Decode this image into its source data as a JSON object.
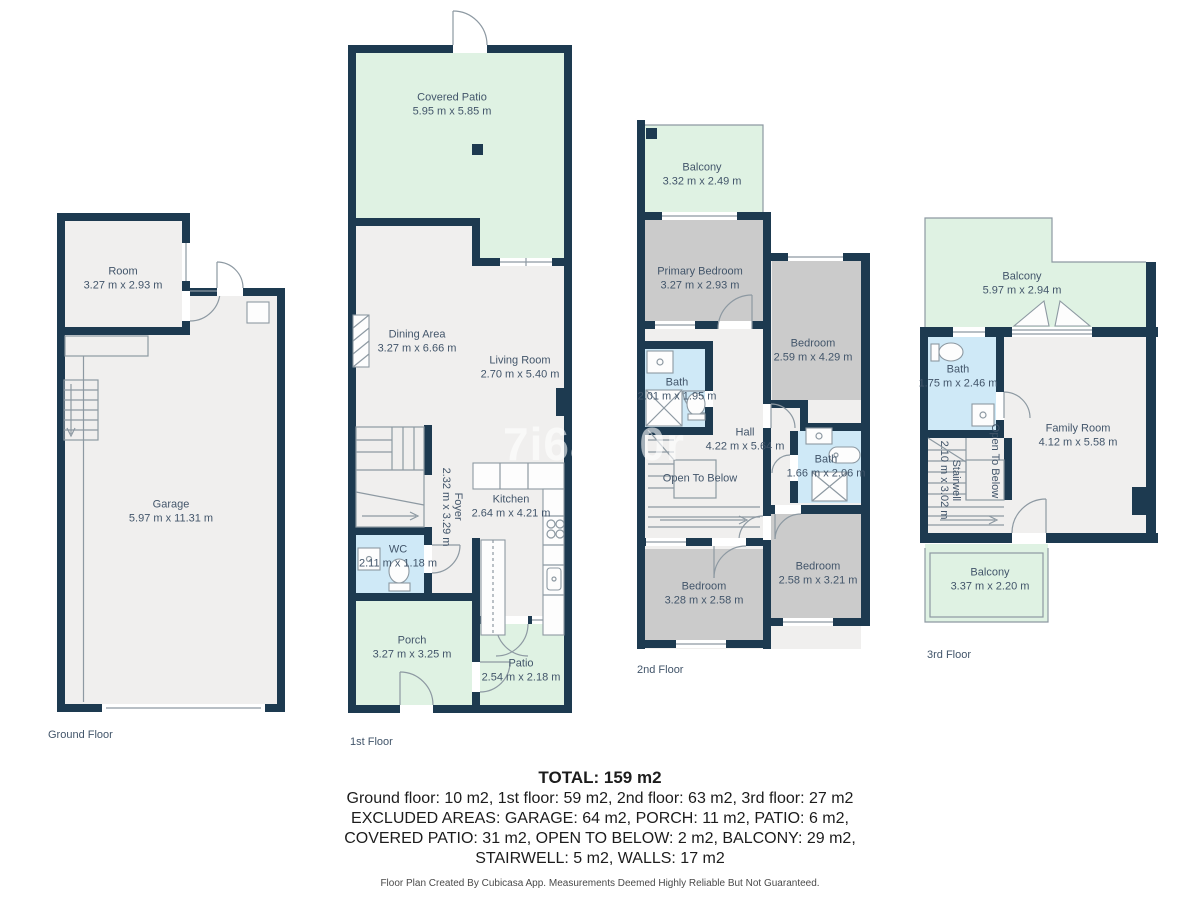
{
  "watermark": "7i6af30r",
  "ground": {
    "floor_label": "Ground Floor",
    "room_name": "Room",
    "room_dims": "3.27 m x 2.93 m",
    "garage_name": "Garage",
    "garage_dims": "5.97 m x 11.31 m"
  },
  "first": {
    "floor_label": "1st Floor",
    "covered_patio_name": "Covered Patio",
    "covered_patio_dims": "5.95 m x 5.85 m",
    "dining_name": "Dining Area",
    "dining_dims": "3.27 m x 6.66 m",
    "living_name": "Living Room",
    "living_dims": "2.70 m x 5.40 m",
    "kitchen_name": "Kitchen",
    "kitchen_dims": "2.64 m x 4.21 m",
    "foyer_name": "Foyer",
    "foyer_dims": "2.32 m x 3.29 m",
    "wc_name": "WC",
    "wc_dims": "2.11 m x 1.18 m",
    "porch_name": "Porch",
    "porch_dims": "3.27 m x 3.25 m",
    "patio_name": "Patio",
    "patio_dims": "2.54 m x 2.18 m"
  },
  "second": {
    "floor_label": "2nd Floor",
    "balcony_name": "Balcony",
    "balcony_dims": "3.32 m x 2.49 m",
    "primary_name": "Primary Bedroom",
    "primary_dims": "3.27 m x 2.93 m",
    "bedroom_r_name": "Bedroom",
    "bedroom_r_dims": "2.59 m x 4.29 m",
    "bath1_name": "Bath",
    "bath1_dims": "2.01 m x 1.95 m",
    "hall_name": "Hall",
    "hall_dims": "4.22 m x 5.64 m",
    "open_below": "Open To Below",
    "bath2_name": "Bath",
    "bath2_dims": "1.66 m x 2.06 m",
    "bedroom_bl_name": "Bedroom",
    "bedroom_bl_dims": "3.28 m x 2.58 m",
    "bedroom_br_name": "Bedroom",
    "bedroom_br_dims": "2.58 m x 3.21 m"
  },
  "third": {
    "floor_label": "3rd Floor",
    "balcony_top_name": "Balcony",
    "balcony_top_dims": "5.97 m x 2.94 m",
    "bath_name": "Bath",
    "bath_dims": "1.75 m x 2.46 m",
    "family_name": "Family Room",
    "family_dims": "4.12 m x 5.58 m",
    "stairwell_name": "Stairwell",
    "stairwell_dims": "2.10 m x 3.02 m",
    "open_below": "Open To Below",
    "balcony_bottom_name": "Balcony",
    "balcony_bottom_dims": "3.37 m x 2.20 m"
  },
  "summary": {
    "total": "TOTAL: 159 m2",
    "line1": "Ground floor: 10 m2, 1st floor: 59 m2, 2nd floor: 63 m2, 3rd floor: 27 m2",
    "line2": "EXCLUDED AREAS: GARAGE: 64 m2, PORCH: 11 m2, PATIO: 6 m2,",
    "line3": "COVERED PATIO: 31 m2, OPEN TO BELOW: 2 m2, BALCONY: 29 m2,",
    "line4": "STAIRWELL: 5 m2, WALLS: 17 m2",
    "disclaimer": "Floor Plan Created By Cubicasa App. Measurements Deemed Highly Reliable But Not Guaranteed."
  },
  "colors": {
    "wall": "#1d3a50",
    "outdoor_green": "#dff2e3",
    "bath_blue": "#cfe9f7",
    "bedroom_gray": "#cbcbcb",
    "floor_gray": "#f0efee"
  }
}
